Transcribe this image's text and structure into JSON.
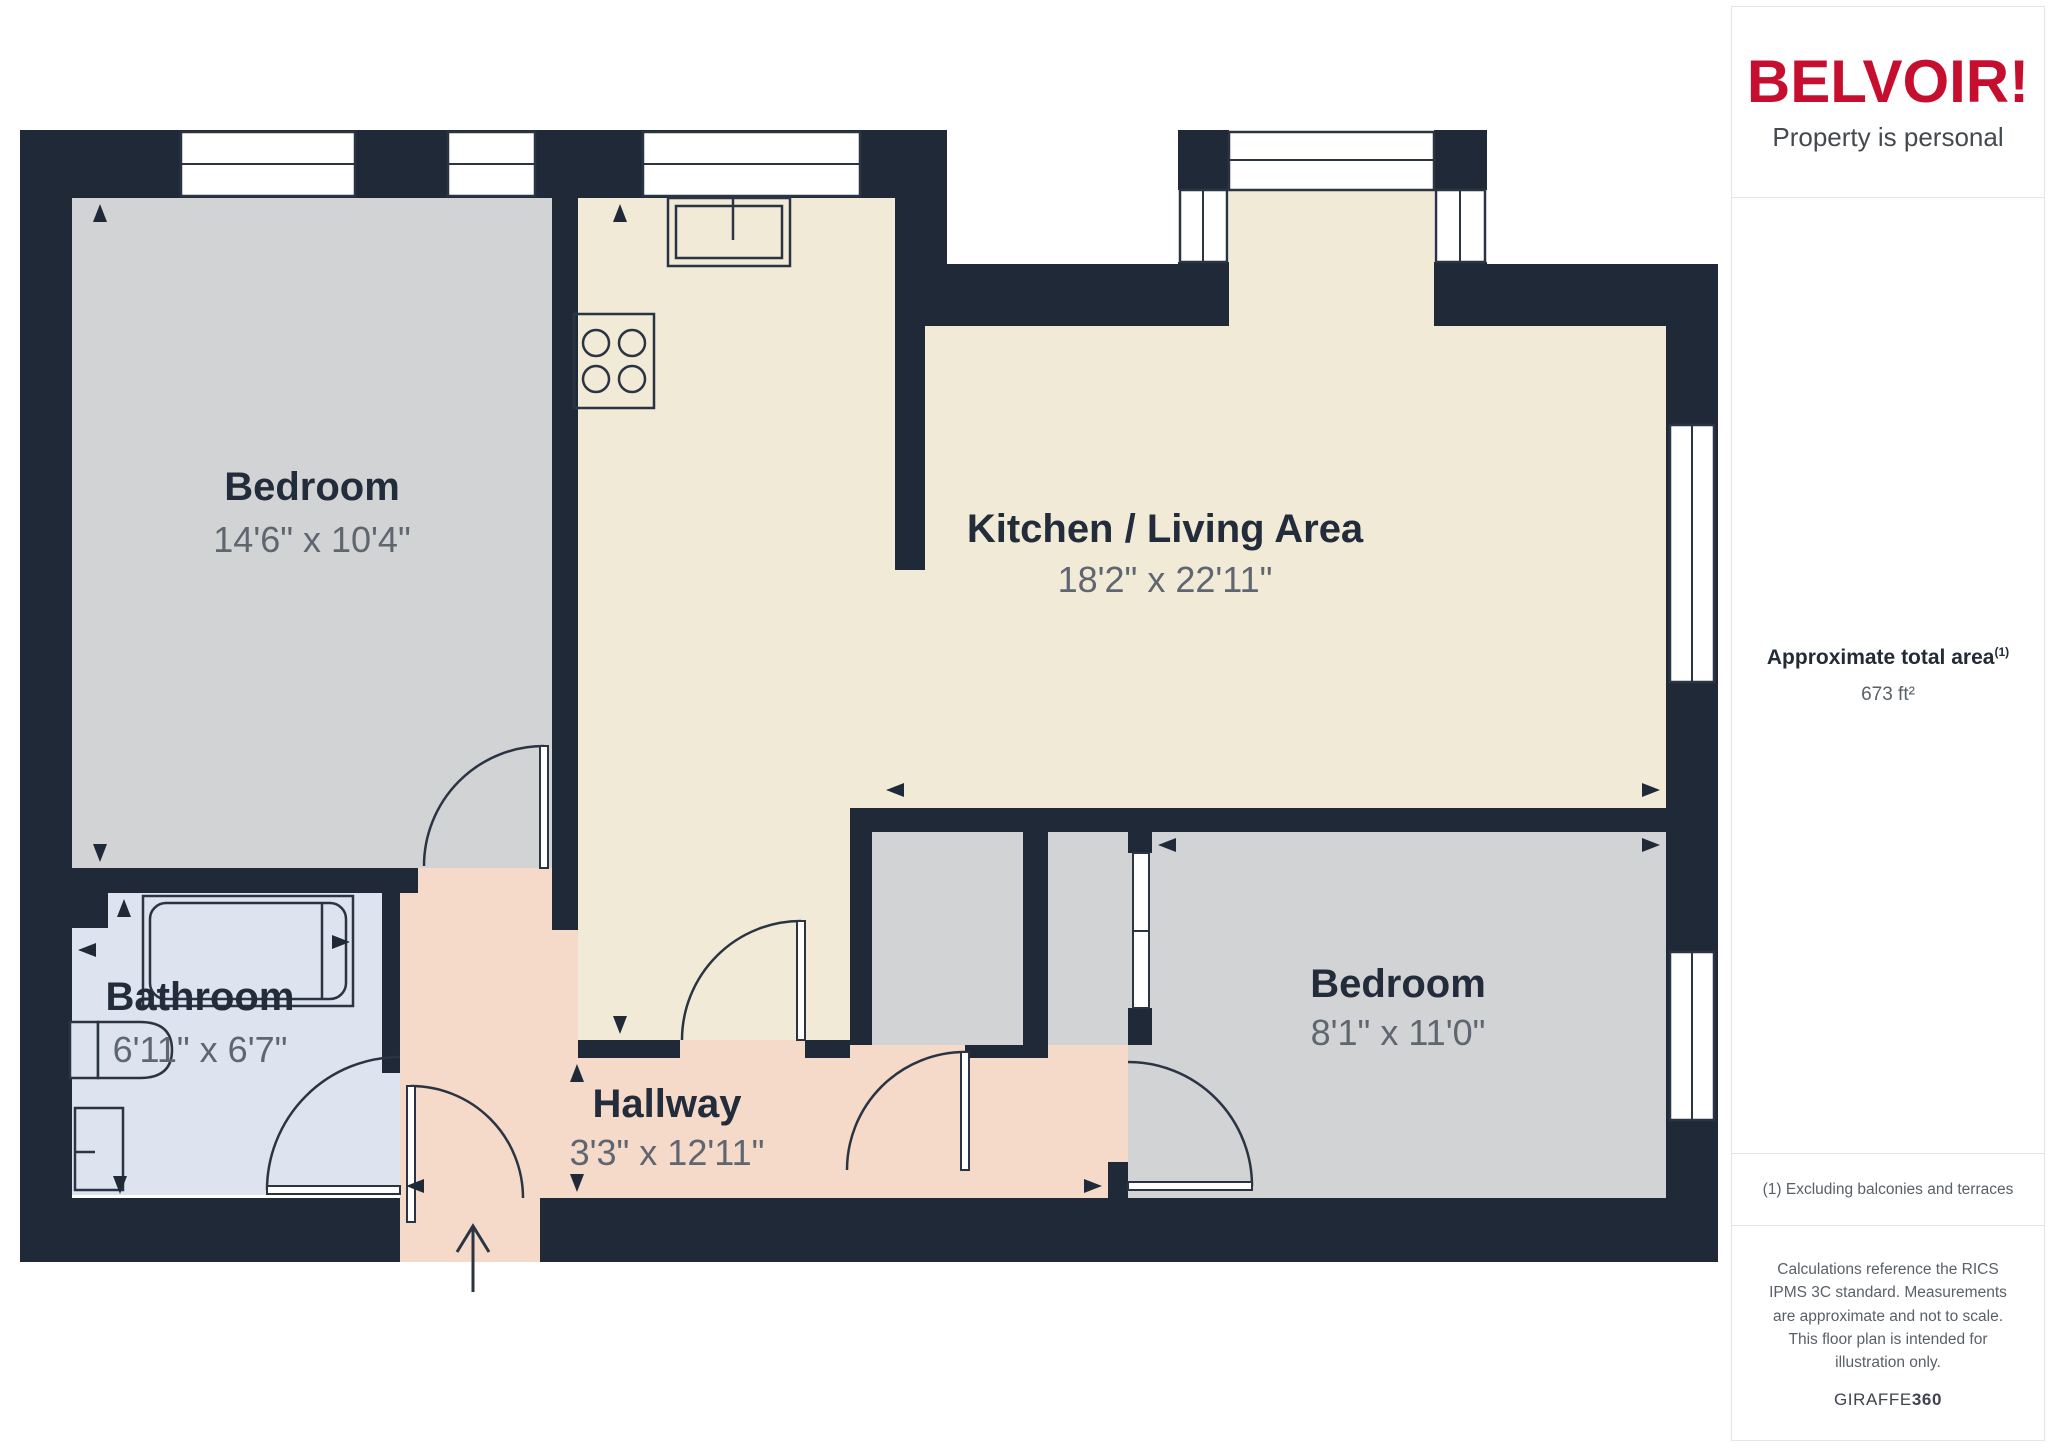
{
  "canvas": {
    "width": 2048,
    "height": 1447
  },
  "branding": {
    "logo_text": "BELVOIR!",
    "tagline": "Property is personal",
    "brand_color": "#c60f2f"
  },
  "sidebar": {
    "area_label": "Approximate total area",
    "area_footnote_marker": "(1)",
    "area_value": "673 ft²",
    "footnote": "(1) Excluding balconies and terraces",
    "disclaimer": "Calculations reference the RICS IPMS 3C standard. Measurements are approximate and not to scale. This floor plan is intended for illustration only.",
    "provider_name": "GIRAFFE",
    "provider_number": "360"
  },
  "floorplan": {
    "rooms": [
      {
        "id": "bedroom-1",
        "name": "Bedroom",
        "dimensions": "14'6\" x 10'4\""
      },
      {
        "id": "kitchen-living",
        "name": "Kitchen / Living Area",
        "dimensions": "18'2\" x 22'11\""
      },
      {
        "id": "bathroom",
        "name": "Bathroom",
        "dimensions": "6'11\" x 6'7\""
      },
      {
        "id": "hallway",
        "name": "Hallway",
        "dimensions": "3'3\" x 12'11\""
      },
      {
        "id": "bedroom-2",
        "name": "Bedroom",
        "dimensions": "8'1\" x 11'0\""
      }
    ],
    "fixtures": [
      "kitchen-sink",
      "stove-hob",
      "bathtub",
      "toilet",
      "bathroom-sink",
      "sliding-door",
      "entrance-arrow"
    ],
    "colors": {
      "wall": "#1f2937",
      "line": "#2a3442",
      "bedroom": "#d2d3d5",
      "kitchen": "#f1ead7",
      "bathroom": "#dee4ef",
      "hallway": "#f5dac9",
      "window": "#ffffff",
      "room_title": "#222c3a",
      "room_dims": "#5f6670"
    }
  }
}
